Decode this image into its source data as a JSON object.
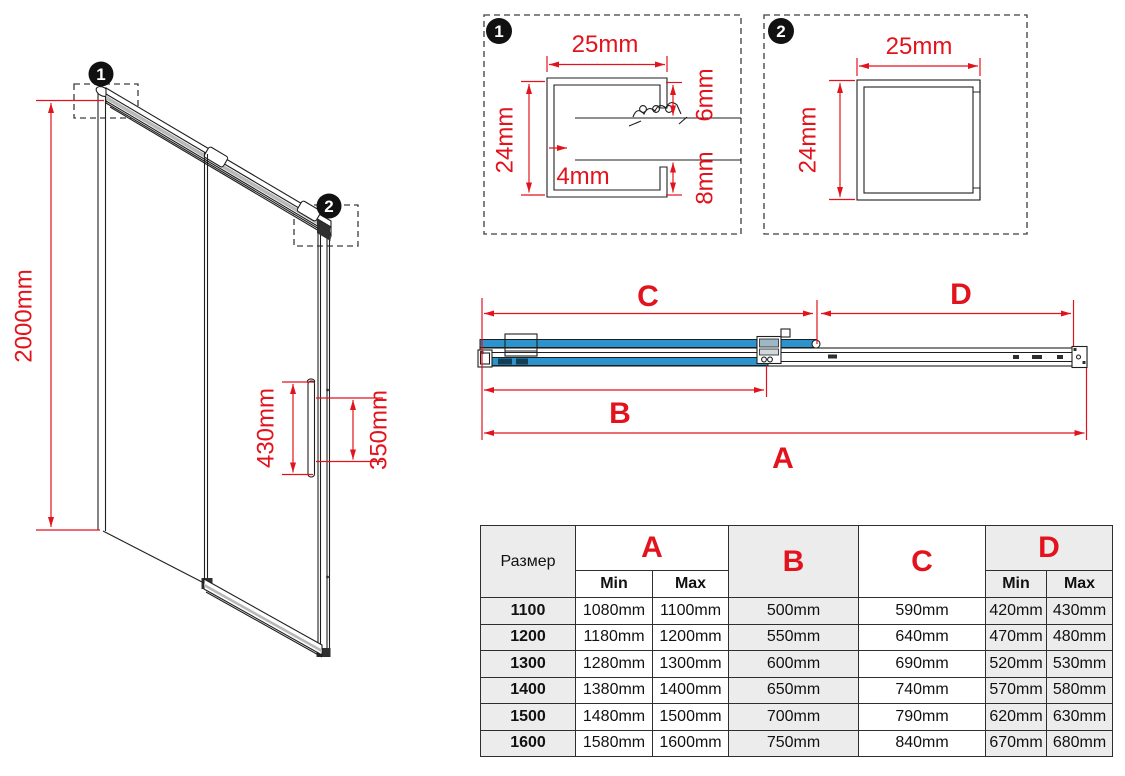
{
  "colors": {
    "dim_red": "#e2131c",
    "glass_blue": "#2e93cc",
    "line_dark": "#1f1f1f",
    "table_gray": "#ececec"
  },
  "door_view": {
    "badge1": "1",
    "badge2": "2",
    "height_dim": "2000mm",
    "handle_outer_dim": "430mm",
    "handle_inner_dim": "350mm"
  },
  "detail1": {
    "badge": "1",
    "width_dim": "25mm",
    "height_dim": "24mm",
    "top_inset_dim": "6mm",
    "glass_dim": "4mm",
    "bottom_inset_dim": "8mm"
  },
  "detail2": {
    "badge": "2",
    "width_dim": "25mm",
    "height_dim": "24mm"
  },
  "plan_view": {
    "dim_a": "A",
    "dim_b": "B",
    "dim_c": "C",
    "dim_d": "D"
  },
  "size_table": {
    "size_col": "Размер",
    "col_a": "A",
    "col_b": "B",
    "col_c": "C",
    "col_d": "D",
    "min": "Min",
    "max": "Max",
    "rows": [
      {
        "size": "1100",
        "a_min": "1080mm",
        "a_max": "1100mm",
        "b": "500mm",
        "c": "590mm",
        "d_min": "420mm",
        "d_max": "430mm"
      },
      {
        "size": "1200",
        "a_min": "1180mm",
        "a_max": "1200mm",
        "b": "550mm",
        "c": "640mm",
        "d_min": "470mm",
        "d_max": "480mm"
      },
      {
        "size": "1300",
        "a_min": "1280mm",
        "a_max": "1300mm",
        "b": "600mm",
        "c": "690mm",
        "d_min": "520mm",
        "d_max": "530mm"
      },
      {
        "size": "1400",
        "a_min": "1380mm",
        "a_max": "1400mm",
        "b": "650mm",
        "c": "740mm",
        "d_min": "570mm",
        "d_max": "580mm"
      },
      {
        "size": "1500",
        "a_min": "1480mm",
        "a_max": "1500mm",
        "b": "700mm",
        "c": "790mm",
        "d_min": "620mm",
        "d_max": "630mm"
      },
      {
        "size": "1600",
        "a_min": "1580mm",
        "a_max": "1600mm",
        "b": "750mm",
        "c": "840mm",
        "d_min": "670mm",
        "d_max": "680mm"
      }
    ]
  }
}
